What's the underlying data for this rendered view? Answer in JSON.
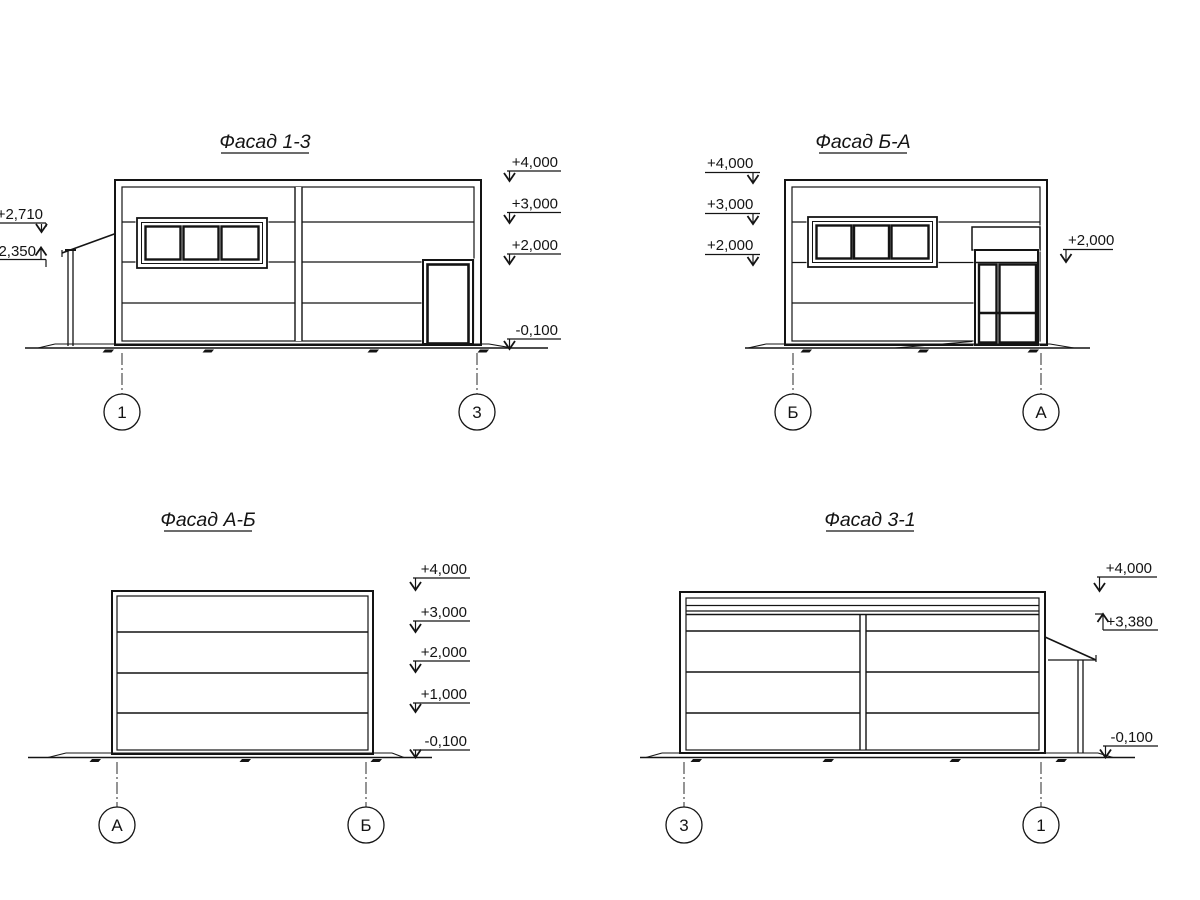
{
  "drawing": {
    "background": "#ffffff",
    "line_color": "#141414",
    "facades": {
      "f13": {
        "title": "Фасад 1-3",
        "marks_right": [
          "+4,000",
          "+3,000",
          "+2,000",
          "-0,100"
        ],
        "marks_left": [
          "+2,710",
          "2,350"
        ],
        "axes": [
          "1",
          "3"
        ]
      },
      "fba": {
        "title": "Фасад Б-А",
        "marks_left": [
          "+4,000",
          "+3,000",
          "+2,000"
        ],
        "marks_right": [
          "+2,000"
        ],
        "axes": [
          "Б",
          "А"
        ]
      },
      "fab": {
        "title": "Фасад А-Б",
        "marks_right": [
          "+4,000",
          "+3,000",
          "+2,000",
          "+1,000",
          "-0,100"
        ],
        "axes": [
          "А",
          "Б"
        ]
      },
      "f31": {
        "title": "Фасад 3-1",
        "marks_right": [
          "+4,000",
          "+3,380",
          "-0,100"
        ],
        "axes": [
          "3",
          "1"
        ]
      }
    }
  }
}
